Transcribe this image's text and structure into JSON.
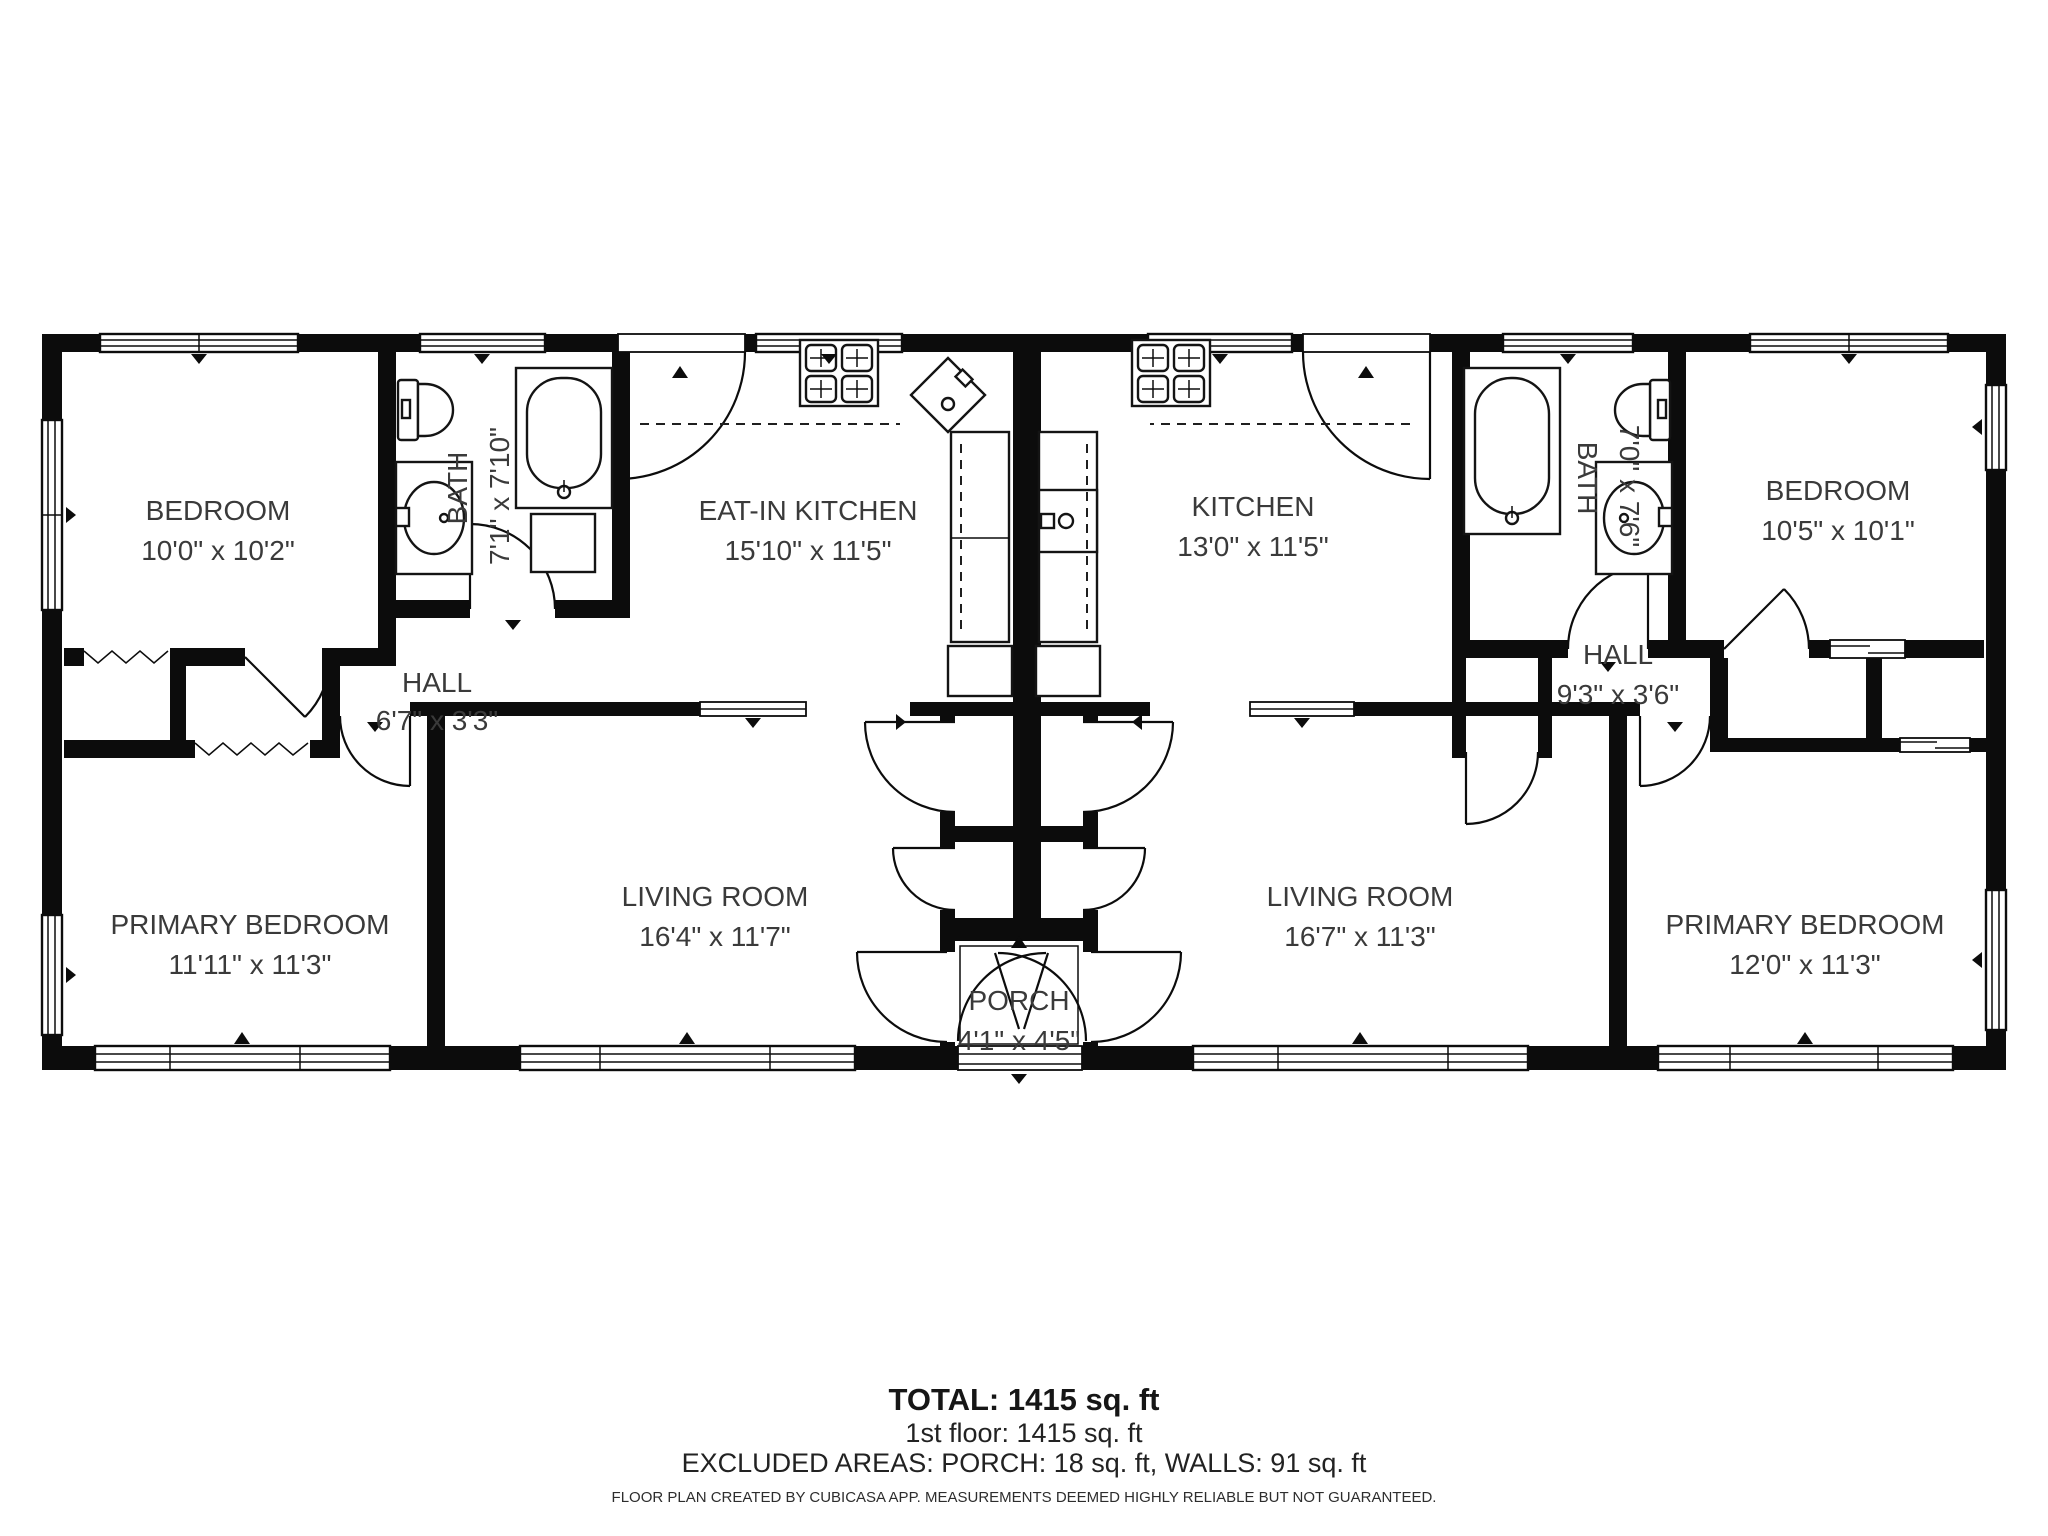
{
  "colors": {
    "wall": "#0c0c0c",
    "text": "#3a3a3a",
    "background": "#ffffff"
  },
  "floor_plan": {
    "rooms": [
      {
        "id": "bedroom-left",
        "name": "BEDROOM",
        "dims": "10'0\" x 10'2\""
      },
      {
        "id": "bath-left",
        "name": "BATH",
        "dims": "7'1\" x 7'10\""
      },
      {
        "id": "eat-in-kitchen",
        "name": "EAT-IN KITCHEN",
        "dims": "15'10\" x 11'5\""
      },
      {
        "id": "hall-left",
        "name": "HALL",
        "dims": "6'7\" x 3'3\""
      },
      {
        "id": "primary-bedroom-left",
        "name": "PRIMARY BEDROOM",
        "dims": "11'11\" x 11'3\""
      },
      {
        "id": "living-room-left",
        "name": "LIVING ROOM",
        "dims": "16'4\" x 11'7\""
      },
      {
        "id": "porch",
        "name": "PORCH",
        "dims": "4'1\" x 4'5\""
      },
      {
        "id": "living-room-right",
        "name": "LIVING ROOM",
        "dims": "16'7\" x 11'3\""
      },
      {
        "id": "primary-bedroom-right",
        "name": "PRIMARY BEDROOM",
        "dims": "12'0\" x 11'3\""
      },
      {
        "id": "kitchen-right",
        "name": "KITCHEN",
        "dims": "13'0\" x 11'5\""
      },
      {
        "id": "bath-right",
        "name": "BATH",
        "dims": "7'0\" x 7'6\""
      },
      {
        "id": "bedroom-right",
        "name": "BEDROOM",
        "dims": "10'5\" x 10'1\""
      },
      {
        "id": "hall-right",
        "name": "HALL",
        "dims": "9'3\" x 3'6\""
      }
    ],
    "footer": {
      "total": "TOTAL: 1415 sq. ft",
      "first_floor": "1st floor: 1415 sq. ft",
      "excluded": "EXCLUDED AREAS: PORCH: 18 sq. ft, WALLS: 91 sq. ft",
      "disclaimer": "FLOOR PLAN CREATED BY CUBICASA APP. MEASUREMENTS DEEMED HIGHLY RELIABLE BUT NOT GUARANTEED."
    }
  }
}
